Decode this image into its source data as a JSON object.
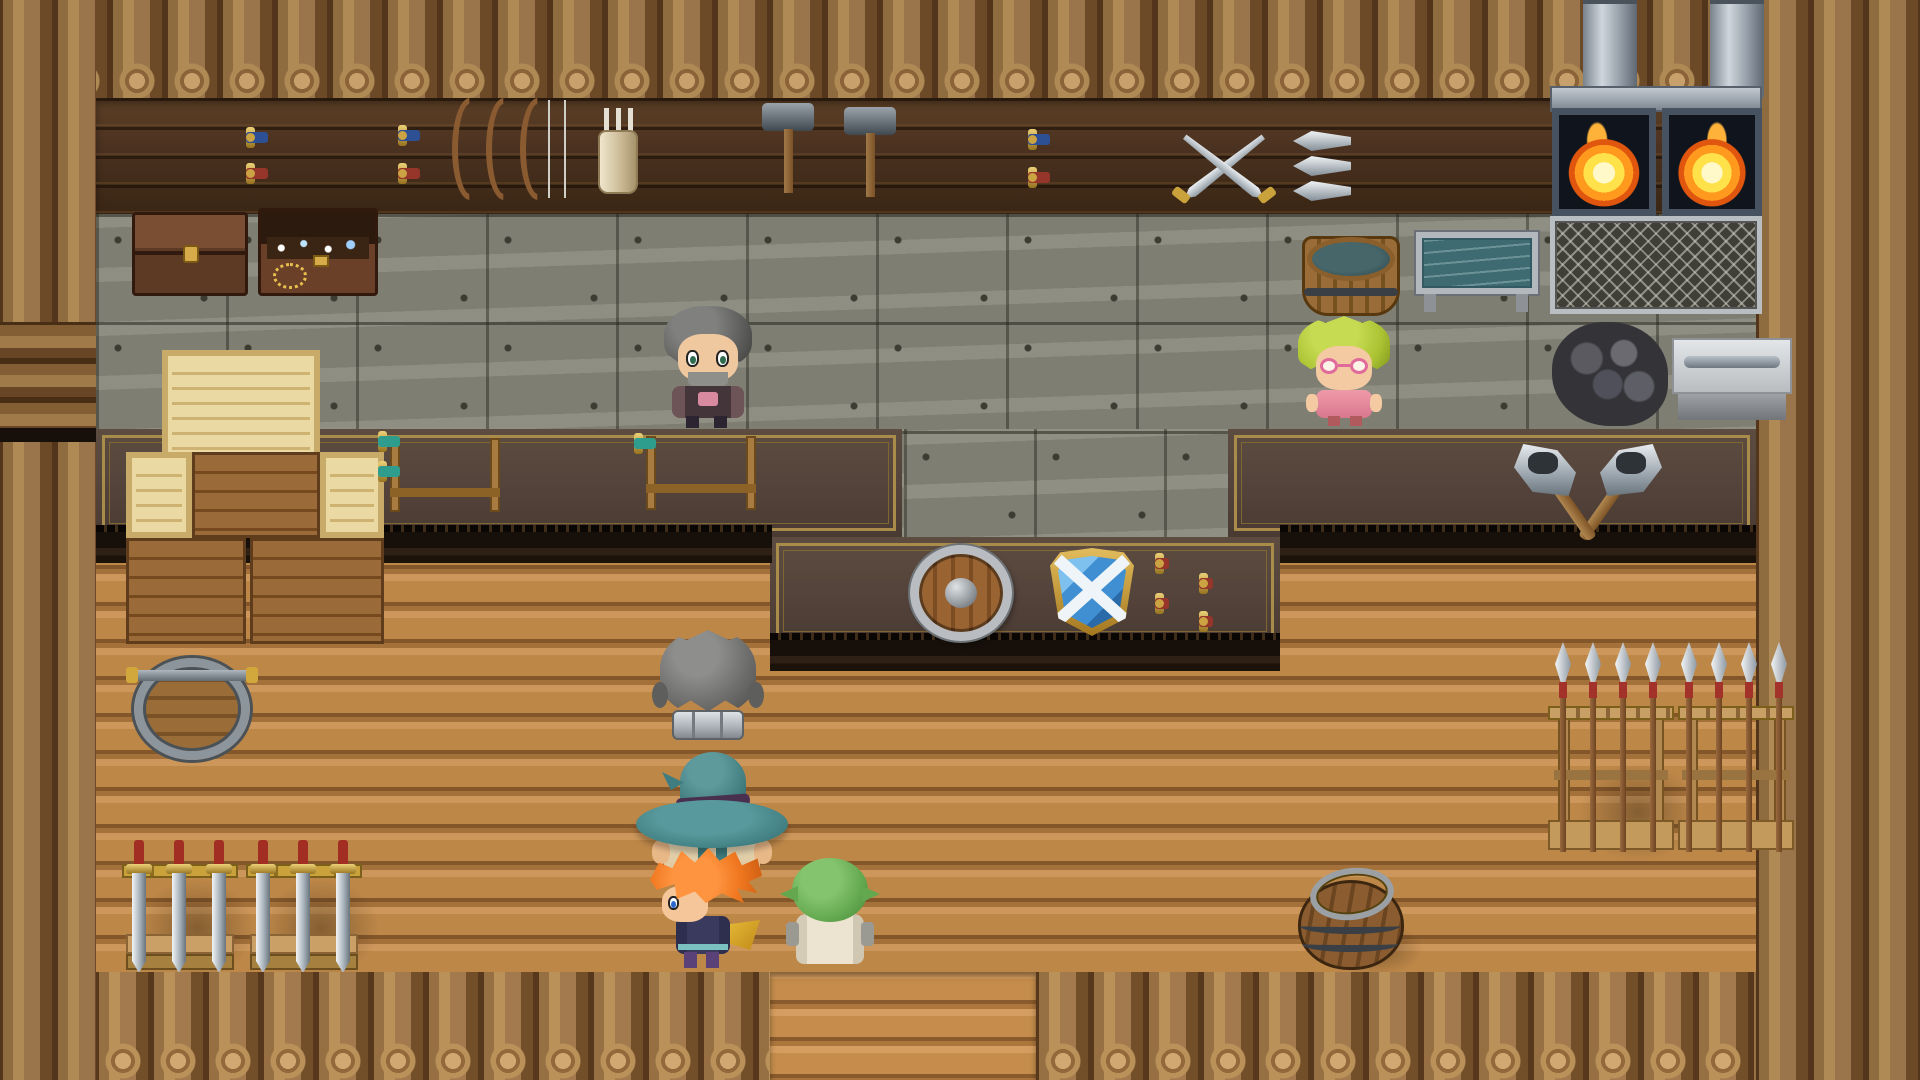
{
  "scene": {
    "game_style": "top-down RPG interior (RPG Maker style)",
    "location_kind": "blacksmith weapon shop",
    "visible_text": "none",
    "palette": {
      "log_wall": "#8f6b40",
      "plank_wall_dark": "#4a3120",
      "stone_wall": "#86867a",
      "counter_surface": "#52423a",
      "counter_trim_gold": "#a98c4a",
      "floor_wood": "#c08a4a",
      "fire_orange": "#ff9a1f",
      "fire_yellow": "#ffe24a",
      "water_teal": "#3e6a6e",
      "shield_blue": "#3f8fd2",
      "shield_gold": "#c9a23c",
      "hero_hair_orange": "#f07820",
      "mage_hat_teal": "#3f7d80",
      "goblin_green": "#63a84f",
      "shopkeeper_hair_green": "#aac232",
      "blacksmith_hair_gray": "#5a5a58"
    },
    "characters": [
      {
        "id": "blacksmith-npc",
        "desc": "gray spiky-haired bearded man in dark armor standing at counter",
        "facing": "south"
      },
      {
        "id": "shopkeeper-npc",
        "desc": "yellow-green haired person with pink glasses and pink outfit at counter",
        "facing": "south"
      },
      {
        "id": "party-knight",
        "desc": "gray-haired fighter with silver armor collar",
        "facing": "north"
      },
      {
        "id": "party-mage",
        "desc": "traveler with wide teal brimmed hat and cream robe",
        "facing": "north"
      },
      {
        "id": "party-hero",
        "desc": "spiky orange-haired hero with gold scarf and purple boots",
        "facing": "west"
      },
      {
        "id": "party-goblin",
        "desc": "small green-headed companion in cream robe",
        "facing": "north"
      }
    ],
    "objects": [
      "wall sword pair (blue and red grips) x2",
      "wall sword pair near center (blue and red grips)",
      "three recurve bows with strings",
      "quiver with arrows",
      "two smith hammers",
      "crossed short swords",
      "three horizontal spears",
      "twin furnaces with fire and chimneys",
      "metal grate panel",
      "coal pile",
      "grinding work table with blade",
      "closed treasure chest",
      "open treasure chest with loot",
      "wooden water tub",
      "metal water trough",
      "stacked wooden crates",
      "sword display stand with two teal-grip swords",
      "sword display stand with one teal-grip sword",
      "crossed battle axes on counter",
      "round wooden buckler",
      "blue kite shield with white cross",
      "four throwing knives",
      "barrel with coiled wire and rod",
      "two floor racks of three downward swords",
      "two floor racks of four upright spears",
      "wooden barrel with lid",
      "south doorway opening"
    ]
  }
}
